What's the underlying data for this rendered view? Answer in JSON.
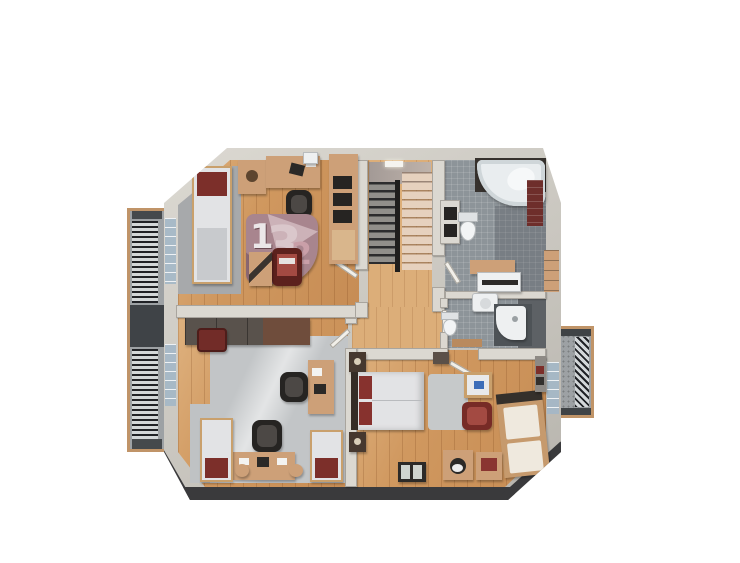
{
  "rug": {
    "one": "1",
    "two": "2",
    "three": "3"
  },
  "colors": {
    "bg": "#ffffff",
    "wall": "#c9c6bf",
    "wall-face": "#dbd8d1",
    "edge": "#3a3a3c",
    "wood": "#d0985f",
    "wood-light": "#dcae79",
    "carpet": "#c2c5c7",
    "carpet-dark": "#a7a9ab",
    "tile": "#8d9499",
    "tile-dark": "#5d6165",
    "tan": "#cda078",
    "dark": "#2c2a28",
    "red": "#7c2f2a",
    "red-light": "#a34a42",
    "mattress": "#e2e3e5",
    "mauve": "#a8858e",
    "mauve-light": "#ccb2b8",
    "mauve-dark": "#8a6771",
    "brick": "#6e2e2b",
    "balcony-wood": "#c09468",
    "slat": "#202226",
    "tub": "#e9edef"
  }
}
